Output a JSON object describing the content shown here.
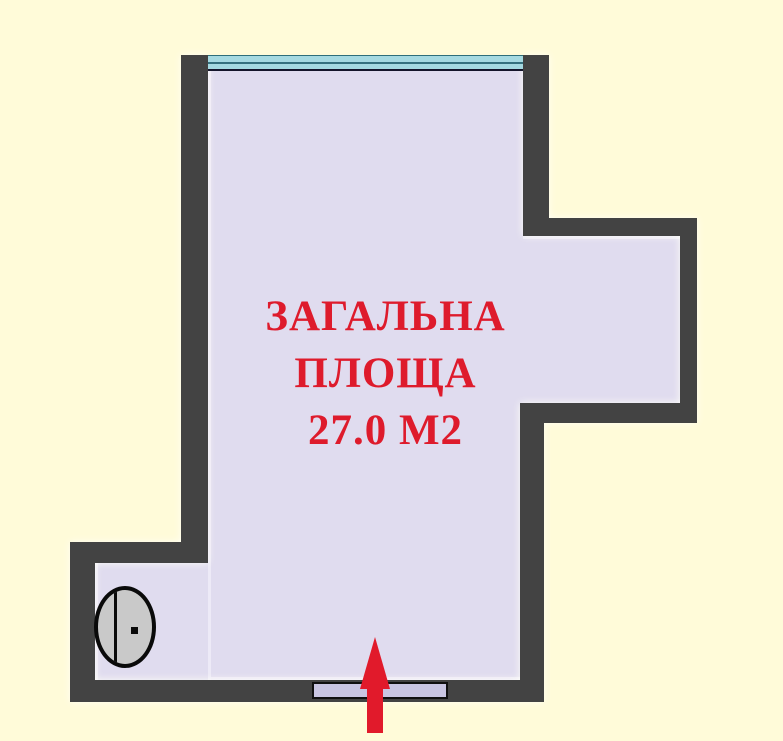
{
  "plan": {
    "title": "Floor plan",
    "area_label_line1": "ЗАГАЛЬНА",
    "area_label_line2": "ПЛОЩА",
    "area_value": "27.0 М2",
    "colors": {
      "background": "#FFFBD9",
      "wall": "#434343",
      "interior": "#E0DCEF",
      "window_cyan": "#A5D9E1",
      "accent_red": "#E11A2B",
      "fixture_gray": "#C9C9C9",
      "threshold_fill": "#C9C5E2"
    },
    "icons": {
      "window": "window-band-icon",
      "entrance": "entrance-arrow-icon",
      "fixture": "oval-fixture-icon"
    }
  }
}
